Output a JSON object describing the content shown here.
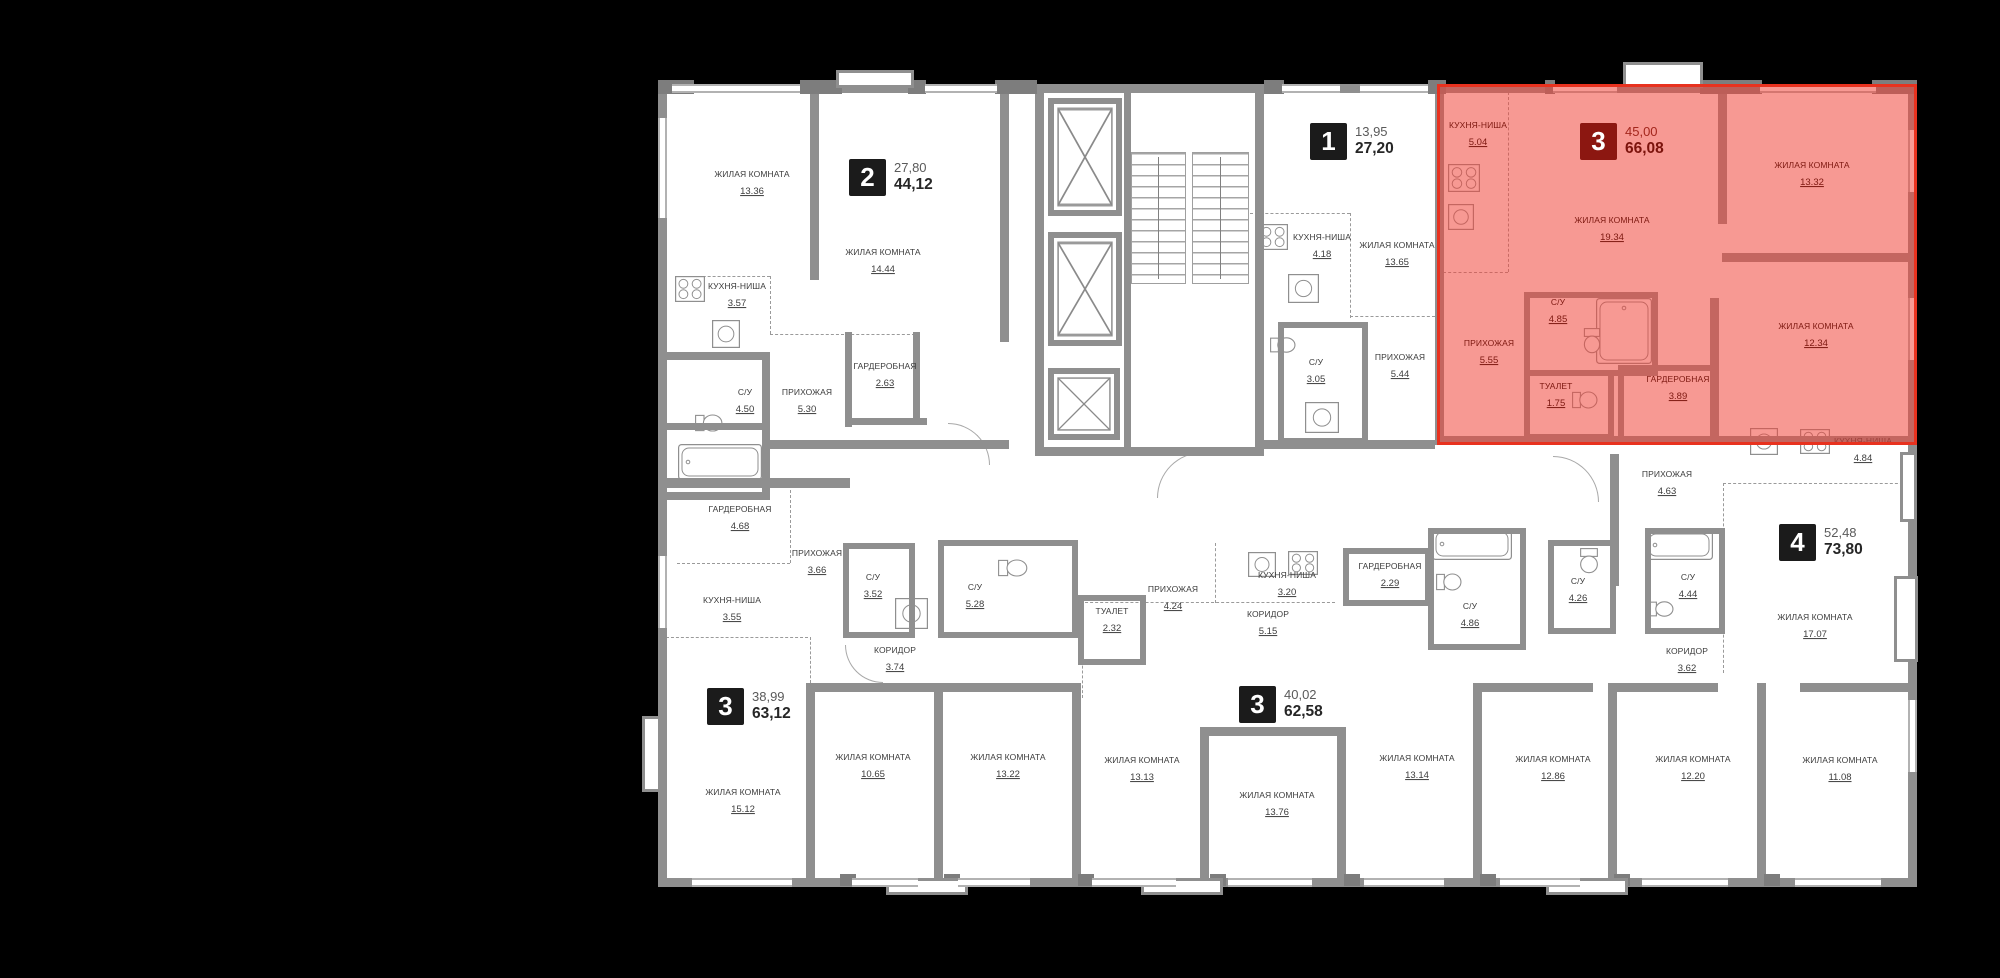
{
  "canvas": {
    "width": 2000,
    "height": 978,
    "background": "#000000"
  },
  "plan": {
    "floor_color": "#ffffff",
    "wall_color": "#8f8f8f",
    "highlight_fill": "#f0463a",
    "highlight_border": "#e8321f",
    "label_color": "#3c3c3c",
    "highlight_label_color": "#7d1810"
  },
  "apartments": [
    {
      "id": "apt-2-top-left",
      "badge": "2",
      "living_area": "27,80",
      "total_area": "44,12",
      "highlighted": false,
      "badge_x": 849,
      "badge_y": 159,
      "rooms": [
        {
          "name": "ЖИЛАЯ КОМНАТА",
          "area": "13.36",
          "x": 752,
          "y": 185
        },
        {
          "name": "ЖИЛАЯ КОМНАТА",
          "area": "14.44",
          "x": 883,
          "y": 263
        },
        {
          "name": "КУХНЯ-НИША",
          "area": "3.57",
          "x": 737,
          "y": 297
        },
        {
          "name": "ГАРДЕРОБНАЯ",
          "area": "2.63",
          "x": 885,
          "y": 377
        },
        {
          "name": "С/У",
          "area": "4.50",
          "x": 745,
          "y": 403
        },
        {
          "name": "ПРИХОЖАЯ",
          "area": "5.30",
          "x": 807,
          "y": 403
        }
      ]
    },
    {
      "id": "apt-1-top-middle",
      "badge": "1",
      "living_area": "13,95",
      "total_area": "27,20",
      "highlighted": false,
      "badge_x": 1310,
      "badge_y": 123,
      "rooms": [
        {
          "name": "КУХНЯ-НИША",
          "area": "4.18",
          "x": 1322,
          "y": 248
        },
        {
          "name": "ЖИЛАЯ КОМНАТА",
          "area": "13.65",
          "x": 1397,
          "y": 256
        },
        {
          "name": "С/У",
          "area": "3.05",
          "x": 1316,
          "y": 373
        },
        {
          "name": "ПРИХОЖАЯ",
          "area": "5.44",
          "x": 1400,
          "y": 368
        }
      ]
    },
    {
      "id": "apt-3-highlighted",
      "badge": "3",
      "living_area": "45,00",
      "total_area": "66,08",
      "highlighted": true,
      "badge_x": 1580,
      "badge_y": 123,
      "rooms": [
        {
          "name": "КУХНЯ-НИША",
          "area": "5.04",
          "x": 1478,
          "y": 136
        },
        {
          "name": "ЖИЛАЯ КОМНАТА",
          "area": "19.34",
          "x": 1612,
          "y": 231
        },
        {
          "name": "ЖИЛАЯ КОМНАТА",
          "area": "13.32",
          "x": 1812,
          "y": 176
        },
        {
          "name": "ЖИЛАЯ КОМНАТА",
          "area": "12.34",
          "x": 1816,
          "y": 337
        },
        {
          "name": "ПРИХОЖАЯ",
          "area": "5.55",
          "x": 1489,
          "y": 354
        },
        {
          "name": "С/У",
          "area": "4.85",
          "x": 1558,
          "y": 313
        },
        {
          "name": "ТУАЛЕТ",
          "area": "1.75",
          "x": 1556,
          "y": 397
        },
        {
          "name": "ГАРДЕРОБНАЯ",
          "area": "3.89",
          "x": 1678,
          "y": 390
        }
      ]
    },
    {
      "id": "apt-3-bottom-left",
      "badge": "3",
      "living_area": "38,99",
      "total_area": "63,12",
      "highlighted": false,
      "badge_x": 707,
      "badge_y": 688,
      "rooms": [
        {
          "name": "ГАРДЕРОБНАЯ",
          "area": "4.68",
          "x": 740,
          "y": 520
        },
        {
          "name": "ПРИХОЖАЯ",
          "area": "3.66",
          "x": 817,
          "y": 564
        },
        {
          "name": "КУХНЯ-НИША",
          "area": "3.55",
          "x": 732,
          "y": 611
        },
        {
          "name": "С/У",
          "area": "3.52",
          "x": 873,
          "y": 588
        },
        {
          "name": "КОРИДОР",
          "area": "3.74",
          "x": 895,
          "y": 661
        },
        {
          "name": "ЖИЛАЯ КОМНАТА",
          "area": "15.12",
          "x": 743,
          "y": 803
        },
        {
          "name": "ЖИЛАЯ КОМНАТА",
          "area": "10.65",
          "x": 873,
          "y": 768
        },
        {
          "name": "ЖИЛАЯ КОМНАТА",
          "area": "13.22",
          "x": 1008,
          "y": 768
        }
      ]
    },
    {
      "id": "apt-3-bottom-middle",
      "badge": "3",
      "living_area": "40,02",
      "total_area": "62,58",
      "highlighted": false,
      "badge_x": 1239,
      "badge_y": 686,
      "rooms": [
        {
          "name": "С/У",
          "area": "5.28",
          "x": 975,
          "y": 598
        },
        {
          "name": "ТУАЛЕТ",
          "area": "2.32",
          "x": 1112,
          "y": 622
        },
        {
          "name": "ПРИХОЖАЯ",
          "area": "4.24",
          "x": 1173,
          "y": 600
        },
        {
          "name": "КУХНЯ-НИША",
          "area": "3.20",
          "x": 1287,
          "y": 586
        },
        {
          "name": "КОРИДОР",
          "area": "5.15",
          "x": 1268,
          "y": 625
        },
        {
          "name": "ГАРДЕРОБНАЯ",
          "area": "2.29",
          "x": 1390,
          "y": 577
        },
        {
          "name": "С/У",
          "area": "4.86",
          "x": 1470,
          "y": 617
        },
        {
          "name": "ЖИЛАЯ КОМНАТА",
          "area": "13.13",
          "x": 1142,
          "y": 771
        },
        {
          "name": "ЖИЛАЯ КОМНАТА",
          "area": "13.76",
          "x": 1277,
          "y": 806
        },
        {
          "name": "ЖИЛАЯ КОМНАТА",
          "area": "13.14",
          "x": 1417,
          "y": 769
        }
      ]
    },
    {
      "id": "apt-4-right",
      "badge": "4",
      "living_area": "52,48",
      "total_area": "73,80",
      "highlighted": false,
      "badge_x": 1779,
      "badge_y": 524,
      "rooms": [
        {
          "name": "ПРИХОЖАЯ",
          "area": "4.63",
          "x": 1667,
          "y": 485
        },
        {
          "name": "С/У",
          "area": "4.26",
          "x": 1578,
          "y": 592
        },
        {
          "name": "С/У",
          "area": "4.44",
          "x": 1688,
          "y": 588
        },
        {
          "name": "КОРИДОР",
          "area": "3.62",
          "x": 1687,
          "y": 662
        },
        {
          "name": "КУХНЯ-НИША",
          "area": "4.84",
          "x": 1863,
          "y": 452
        },
        {
          "name": "ЖИЛАЯ КОМНАТА",
          "area": "17.07",
          "x": 1815,
          "y": 628
        },
        {
          "name": "ЖИЛАЯ КОМНАТА",
          "area": "12.86",
          "x": 1553,
          "y": 770
        },
        {
          "name": "ЖИЛАЯ КОМНАТА",
          "area": "12.20",
          "x": 1693,
          "y": 770
        },
        {
          "name": "ЖИЛАЯ КОМНАТА",
          "area": "11.08",
          "x": 1840,
          "y": 771
        }
      ]
    }
  ]
}
